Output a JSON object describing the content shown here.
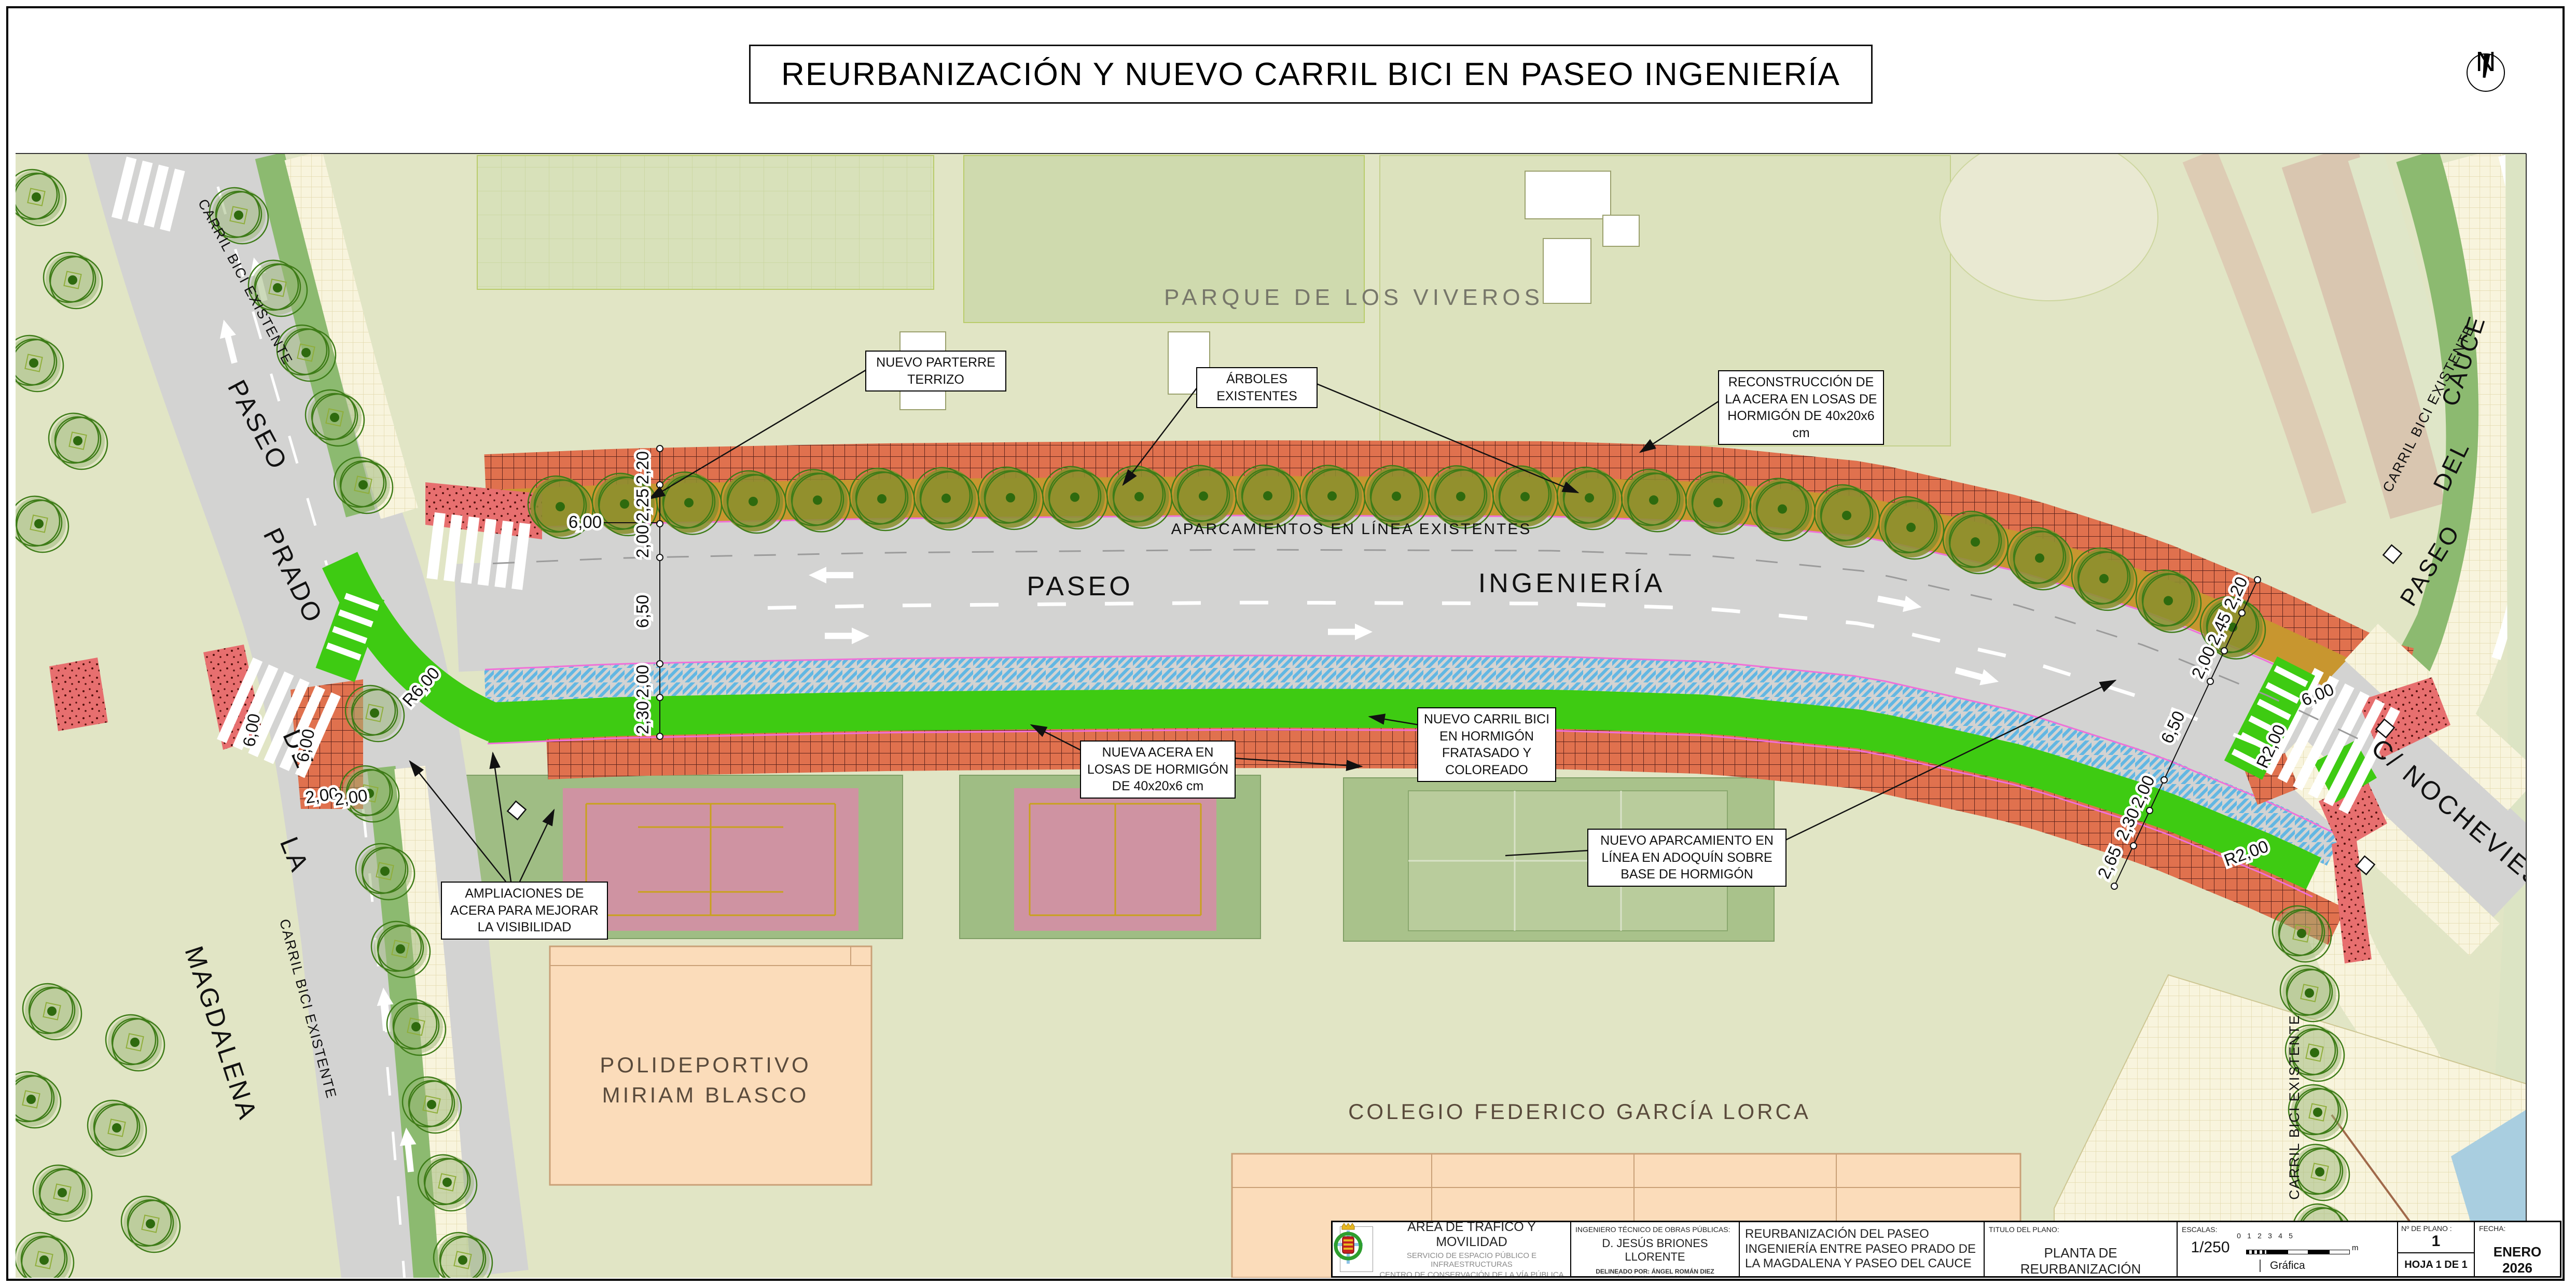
{
  "page": {
    "title": "REURBANIZACIÓN Y NUEVO CARRIL BICI EN PASEO INGENIERÍA",
    "north": "N"
  },
  "areas": {
    "park": "PARQUE  DE  LOS  VIVEROS",
    "sports_line1": "POLIDEPORTIVO",
    "sports_line2": "MIRIAM  BLASCO",
    "school": "COLEGIO  FEDERICO  GARCÍA  LORCA"
  },
  "streets": {
    "ingenieria_w": "PASEO",
    "ingenieria_e": "INGENIERÍA",
    "prado": [
      "PASEO",
      "PRADO",
      "DE",
      "LA",
      "MAGDALENA"
    ],
    "cauce": [
      "PASEO",
      "DEL",
      "CAUCE"
    ],
    "nochevieja": "C/  NOCHEVIEJA",
    "carril_bici_existente": "CARRIL BICI EXISTENTE",
    "aparcamientos_existentes": "APARCAMIENTOS   EN   LÍNEA   EXISTENTES"
  },
  "annotations": {
    "parterre": "NUEVO PARTERRE TERRIZO",
    "arboles": "ÁRBOLES EXISTENTES",
    "reconstruccion": "RECONSTRUCCIÓN DE LA ACERA EN LOSAS DE HORMIGÓN DE 40x20x6 cm",
    "nueva_acera": "NUEVA ACERA EN LOSAS DE HORMIGÓN DE 40x20x6 cm",
    "carril_bici": "NUEVO CARRIL BICI EN HORMIGÓN FRATASADO Y COLOREADO",
    "aparcamiento": "NUEVO APARCAMIENTO EN LÍNEA EN ADOQUÍN SOBRE BASE DE HORMIGÓN",
    "ampliaciones": "AMPLIACIONES DE ACERA PARA MEJORAR LA VISIBILIDAD"
  },
  "dims": {
    "left_chain": [
      "2,20",
      "2,25",
      "2,00",
      "6,50",
      "2,00",
      "2,30"
    ],
    "right_chain": [
      "2,20",
      "2,45",
      "2,00",
      "6,50",
      "2,00",
      "2,30",
      "2,65"
    ],
    "parking_bay": "6,00",
    "crossing_a": "6,00",
    "crossing_b": "6,00",
    "crossing_right": "6,00",
    "pair": [
      "2,00",
      "2,00"
    ],
    "radius_r2": "R2,00",
    "radius_r6": "R6,00"
  },
  "titleblock": {
    "org_title": "ÁREA DE TRÁFICO Y MOVILIDAD",
    "org_sub1": "SERVICIO DE ESPACIO PÚBLICO E INFRAESTRUCTURAS",
    "org_sub2": "CENTRO DE CONSERVACIÓN DE LA VÍA PÚBLICA",
    "engineer_label": "INGENIERO TÉCNICO DE OBRAS PÚBLICAS:",
    "engineer_name": "D. JESÚS BRIONES LLORENTE",
    "drafted_by": "DELINEADO POR: ÁNGEL ROMÁN DIEZ",
    "drafted_area": "Área de Urbanismo y Vivienda",
    "drafted_center": "CENTRO DE CARTOGRAFÍA Y DELINEACIÓN",
    "project_title": "REURBANIZACIÓN DEL PASEO INGENIERÍA ENTRE PASEO PRADO DE LA MAGDALENA Y PASEO DEL CAUCE",
    "plan_title_label": "TITULO DEL PLANO:",
    "plan_title": "PLANTA DE REURBANIZACIÓN",
    "scales_label": "ESCALAS:",
    "scale_value": "1/250",
    "scale_ticks": [
      "0",
      "1",
      "2",
      "3",
      "4",
      "5"
    ],
    "scale_unit": "m",
    "scale_graphic": "Gráfica",
    "plan_number_label": "Nº DE PLANO :",
    "plan_number": "1",
    "sheet_label": "HOJA 1 DE 1",
    "date_label": "FECHA:",
    "date_value": "ENERO  2026"
  }
}
